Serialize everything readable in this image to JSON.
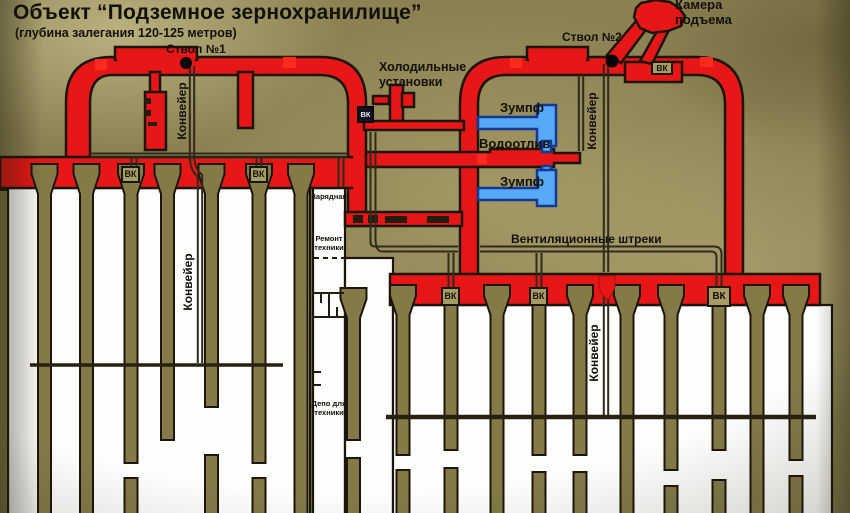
{
  "title": "Объект “Подземное зернохранилище”",
  "subtitle": "(глубина залегания 120-125 метров)",
  "labels": {
    "shaft1": "Ствол №1",
    "shaft2": "Ствол №2",
    "lift_chamber_1": "Камера",
    "lift_chamber_2": "подъема",
    "refrigeration_1": "Холодильные",
    "refrigeration_2": "установки",
    "sump": "Зумпф",
    "drainage": "Водоотлив",
    "vent_drifts": "Вентиляционные штреки",
    "conveyor": "Конвейер",
    "charging": "Зарядная",
    "repair_1": "Ремонт",
    "repair_2": "техники",
    "depot_1": "Депо для",
    "depot_2": "техники",
    "vent_chamber": "ВК"
  },
  "colors": {
    "tunnel_red": "#e81717",
    "marker_red": "#ff2a1e",
    "chamber_white": "#fdfdfc",
    "pillar_olive": "#837a48",
    "sump_blue": "#57a8f7",
    "sump_blue_border": "#123a92",
    "background_olive": "#8b8152",
    "outline_dark": "#1c150a"
  }
}
